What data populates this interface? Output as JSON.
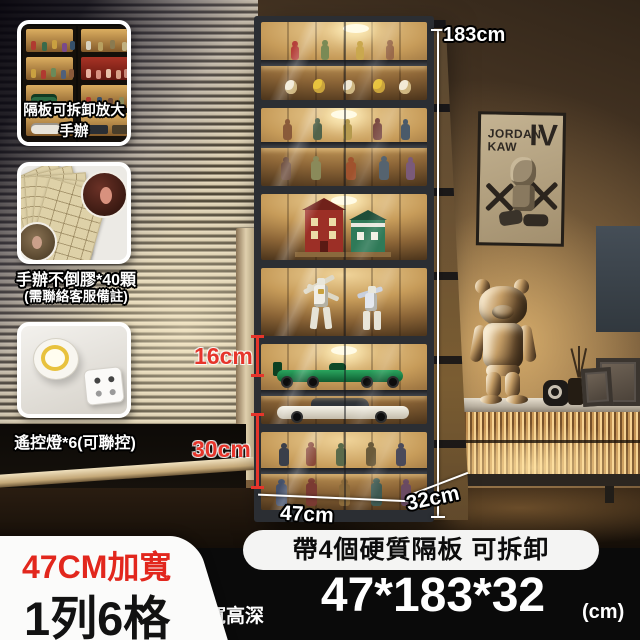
{
  "insets": {
    "shelf_demo": {
      "caption": "隔板可拆卸放大手辦"
    },
    "glue": {
      "caption": "手辦不倒膠*40顆",
      "note": "(需聯絡客服備註)"
    },
    "remote_light": {
      "caption": "遙控燈*6(可聯控)"
    }
  },
  "measurements": {
    "height": "183cm",
    "compartment_small": "16cm",
    "compartment_large": "30cm",
    "width": "47cm",
    "depth": "32cm"
  },
  "badges": {
    "width": "47CM加寬",
    "layout": "1列6格"
  },
  "spec_bar": {
    "feature": "帶4個硬質隔板 可拆卸",
    "dims_label": "寬高深",
    "dims_value": "47*183*32",
    "dims_unit": "(cm)"
  },
  "poster": {
    "line1": "JORDAN",
    "line2": "KAW",
    "line3": "IV"
  },
  "colors": {
    "accent_red": "#e2271d",
    "label_red": "#e6352b",
    "bar_bg": "#0a0a0a",
    "pill_bg": "#f4f4f3",
    "warm_glow": "#d8a75c",
    "cabinet_frame": "#2b2e33"
  }
}
